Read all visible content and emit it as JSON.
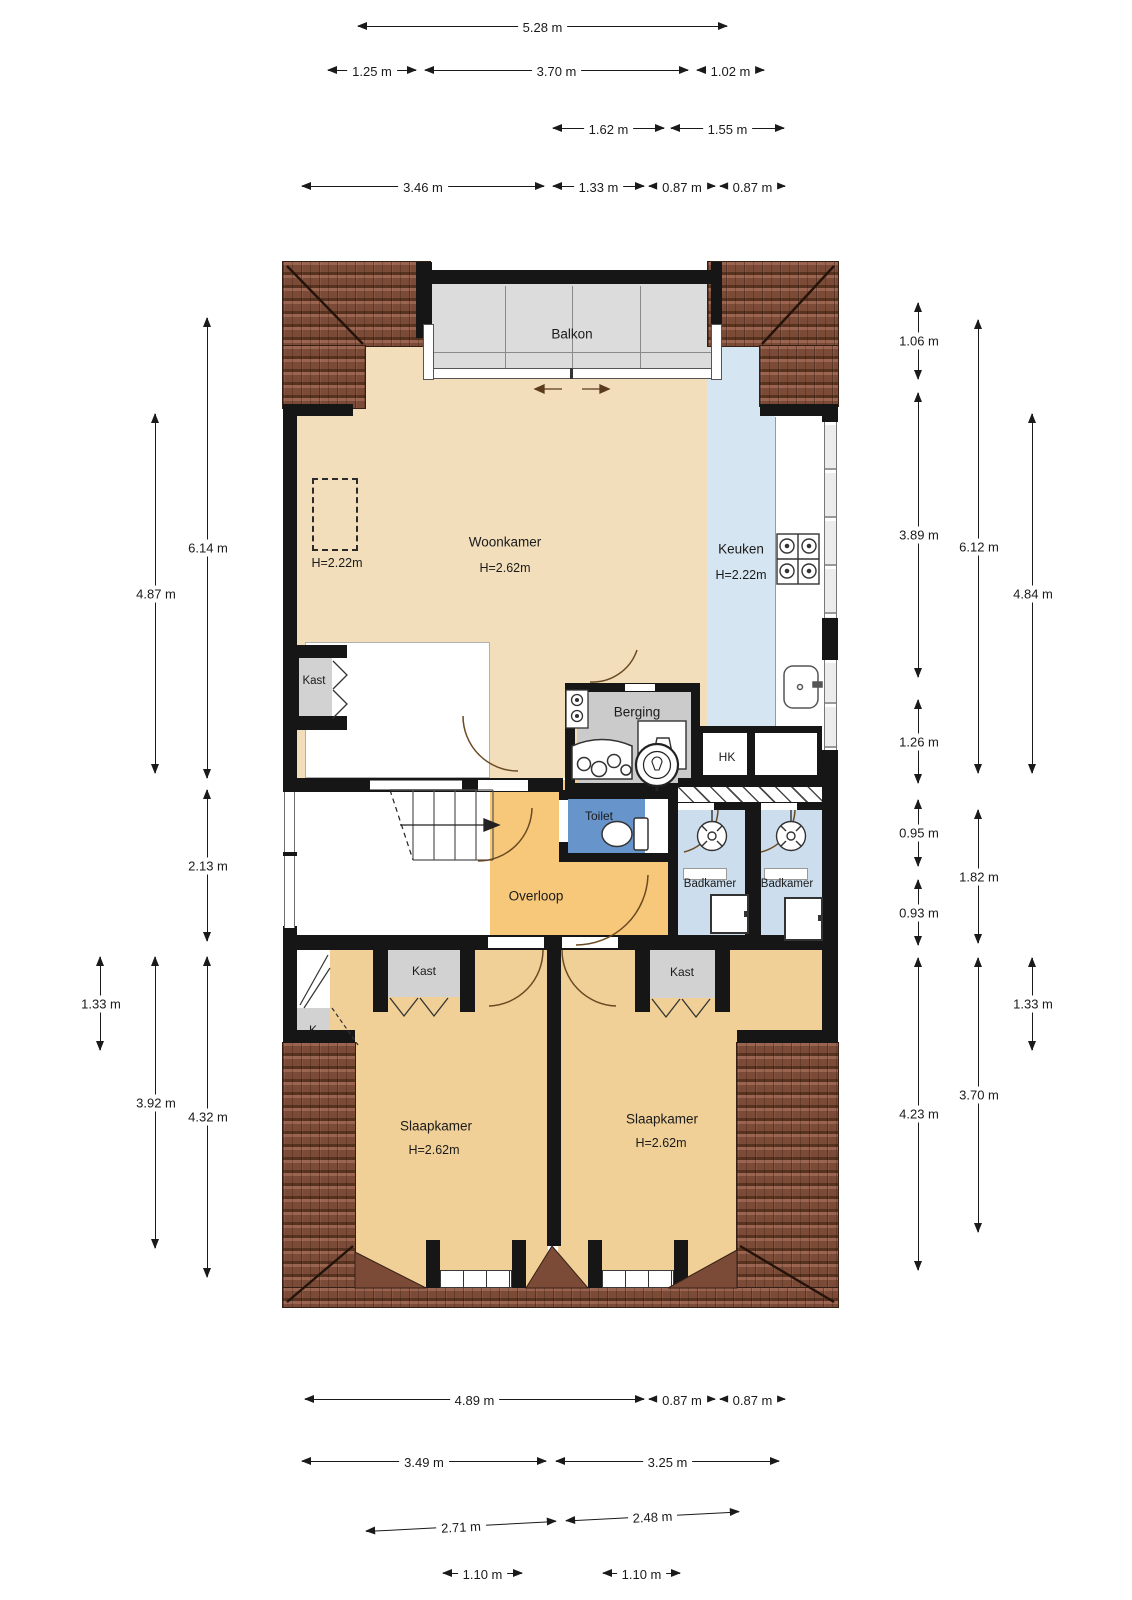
{
  "colors": {
    "wall": "#161616",
    "beige": "#f2deba",
    "orange": "#f7c87a",
    "bedroom": "#f0d096",
    "toiletblue": "#6794cb",
    "bathblue": "#ccdded",
    "kitchenblue": "#d6e5f2",
    "gray": "#d2d2d2",
    "balconygray": "#dcdcdc",
    "rooftile": "#7c4b38"
  },
  "rooms": {
    "balkon": {
      "label": "Balkon"
    },
    "woonkamer": {
      "label": "Woonkamer",
      "height": "H=2.62m"
    },
    "keuken": {
      "label": "Keuken",
      "height": "H=2.22m"
    },
    "dashed_zone": {
      "label": "H=2.22m"
    },
    "kast_wall": {
      "label": "Kast"
    },
    "berging": {
      "label": "Berging"
    },
    "hk": {
      "label": "HK"
    },
    "toilet": {
      "label": "Toilet"
    },
    "overloop": {
      "label": "Overloop"
    },
    "badkamer_left": {
      "label": "Badkamer"
    },
    "badkamer_right": {
      "label": "Badkamer"
    },
    "kast_bedroom_left": {
      "label": "Kast"
    },
    "kast_bedroom_right": {
      "label": "Kast"
    },
    "k_closet": {
      "label": "K"
    },
    "slaapkamer_left": {
      "label": "Slaapkamer",
      "height": "H=2.62m"
    },
    "slaapkamer_right": {
      "label": "Slaapkamer",
      "height": "H=2.62m"
    }
  },
  "dimensions": {
    "top": [
      {
        "label": "5.28 m",
        "x1": 358,
        "x2": 727,
        "y": 26
      },
      {
        "label": "1.25 m",
        "x1": 328,
        "x2": 416,
        "y": 70
      },
      {
        "label": "3.70 m",
        "x1": 425,
        "x2": 688,
        "y": 70
      },
      {
        "label": "1.02 m",
        "x1": 697,
        "x2": 764,
        "y": 70
      },
      {
        "label": "1.62 m",
        "x1": 553,
        "x2": 664,
        "y": 128
      },
      {
        "label": "1.55 m",
        "x1": 671,
        "x2": 784,
        "y": 128
      },
      {
        "label": "3.46 m",
        "x1": 302,
        "x2": 544,
        "y": 186
      },
      {
        "label": "1.33 m",
        "x1": 553,
        "x2": 644,
        "y": 186
      },
      {
        "label": "0.87 m",
        "x1": 649,
        "x2": 715,
        "y": 186
      },
      {
        "label": "0.87 m",
        "x1": 720,
        "x2": 785,
        "y": 186
      }
    ],
    "bottom": [
      {
        "label": "4.89 m",
        "x1": 305,
        "x2": 644,
        "y": 1399
      },
      {
        "label": "0.87 m",
        "x1": 649,
        "x2": 715,
        "y": 1399
      },
      {
        "label": "0.87 m",
        "x1": 720,
        "x2": 785,
        "y": 1399
      },
      {
        "label": "3.49 m",
        "x1": 302,
        "x2": 546,
        "y": 1461
      },
      {
        "label": "3.25 m",
        "x1": 556,
        "x2": 779,
        "y": 1461
      },
      {
        "label": "2.71 m",
        "x1": 366,
        "x2": 556,
        "y": 1526,
        "rot": -3
      },
      {
        "label": "2.48 m",
        "x1": 566,
        "x2": 739,
        "y": 1516,
        "rot": -3
      },
      {
        "label": "1.10 m",
        "x1": 443,
        "x2": 522,
        "y": 1573
      },
      {
        "label": "1.10 m",
        "x1": 603,
        "x2": 680,
        "y": 1573
      }
    ],
    "left": [
      {
        "label": "6.14 m",
        "x": 207,
        "y1": 318,
        "y2": 778
      },
      {
        "label": "4.87 m",
        "x": 155,
        "y1": 414,
        "y2": 773
      },
      {
        "label": "2.13 m",
        "x": 207,
        "y1": 790,
        "y2": 941
      },
      {
        "label": "1.33 m",
        "x": 100,
        "y1": 957,
        "y2": 1050
      },
      {
        "label": "3.92 m",
        "x": 155,
        "y1": 957,
        "y2": 1248
      },
      {
        "label": "4.32 m",
        "x": 207,
        "y1": 957,
        "y2": 1277
      }
    ],
    "right": [
      {
        "label": "1.06 m",
        "x": 918,
        "y1": 303,
        "y2": 379
      },
      {
        "label": "3.89 m",
        "x": 918,
        "y1": 393,
        "y2": 677
      },
      {
        "label": "1.26 m",
        "x": 918,
        "y1": 700,
        "y2": 783
      },
      {
        "label": "0.95 m",
        "x": 918,
        "y1": 800,
        "y2": 866
      },
      {
        "label": "0.93 m",
        "x": 918,
        "y1": 880,
        "y2": 945
      },
      {
        "label": "4.23 m",
        "x": 918,
        "y1": 958,
        "y2": 1270
      },
      {
        "label": "6.12 m",
        "x": 978,
        "y1": 320,
        "y2": 773
      },
      {
        "label": "1.82 m",
        "x": 978,
        "y1": 810,
        "y2": 943
      },
      {
        "label": "3.70 m",
        "x": 978,
        "y1": 958,
        "y2": 1232
      },
      {
        "label": "4.84 m",
        "x": 1032,
        "y1": 414,
        "y2": 773
      },
      {
        "label": "1.33 m",
        "x": 1032,
        "y1": 958,
        "y2": 1050
      }
    ]
  }
}
